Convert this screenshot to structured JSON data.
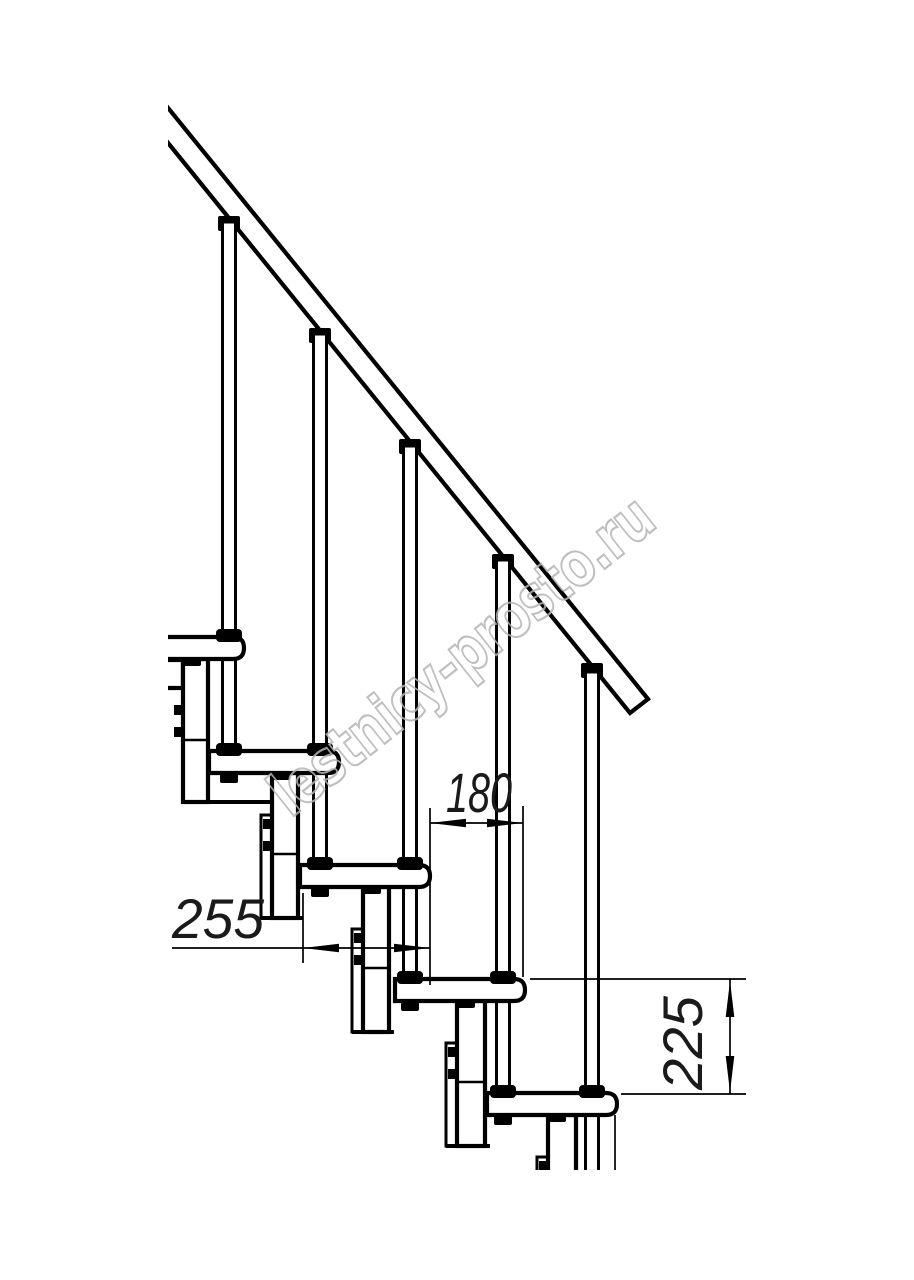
{
  "watermark": {
    "text": "lestnicy-prosto.ru"
  },
  "dimensions": {
    "step_run_mm": "180",
    "tread_depth_mm": "255",
    "riser_height_mm": "225"
  },
  "colors": {
    "line": "#000000",
    "watermark_stroke": "#b4b4b4",
    "background": "#ffffff"
  },
  "structure": {
    "steps_visible": 5,
    "balusters_visible": 5
  }
}
